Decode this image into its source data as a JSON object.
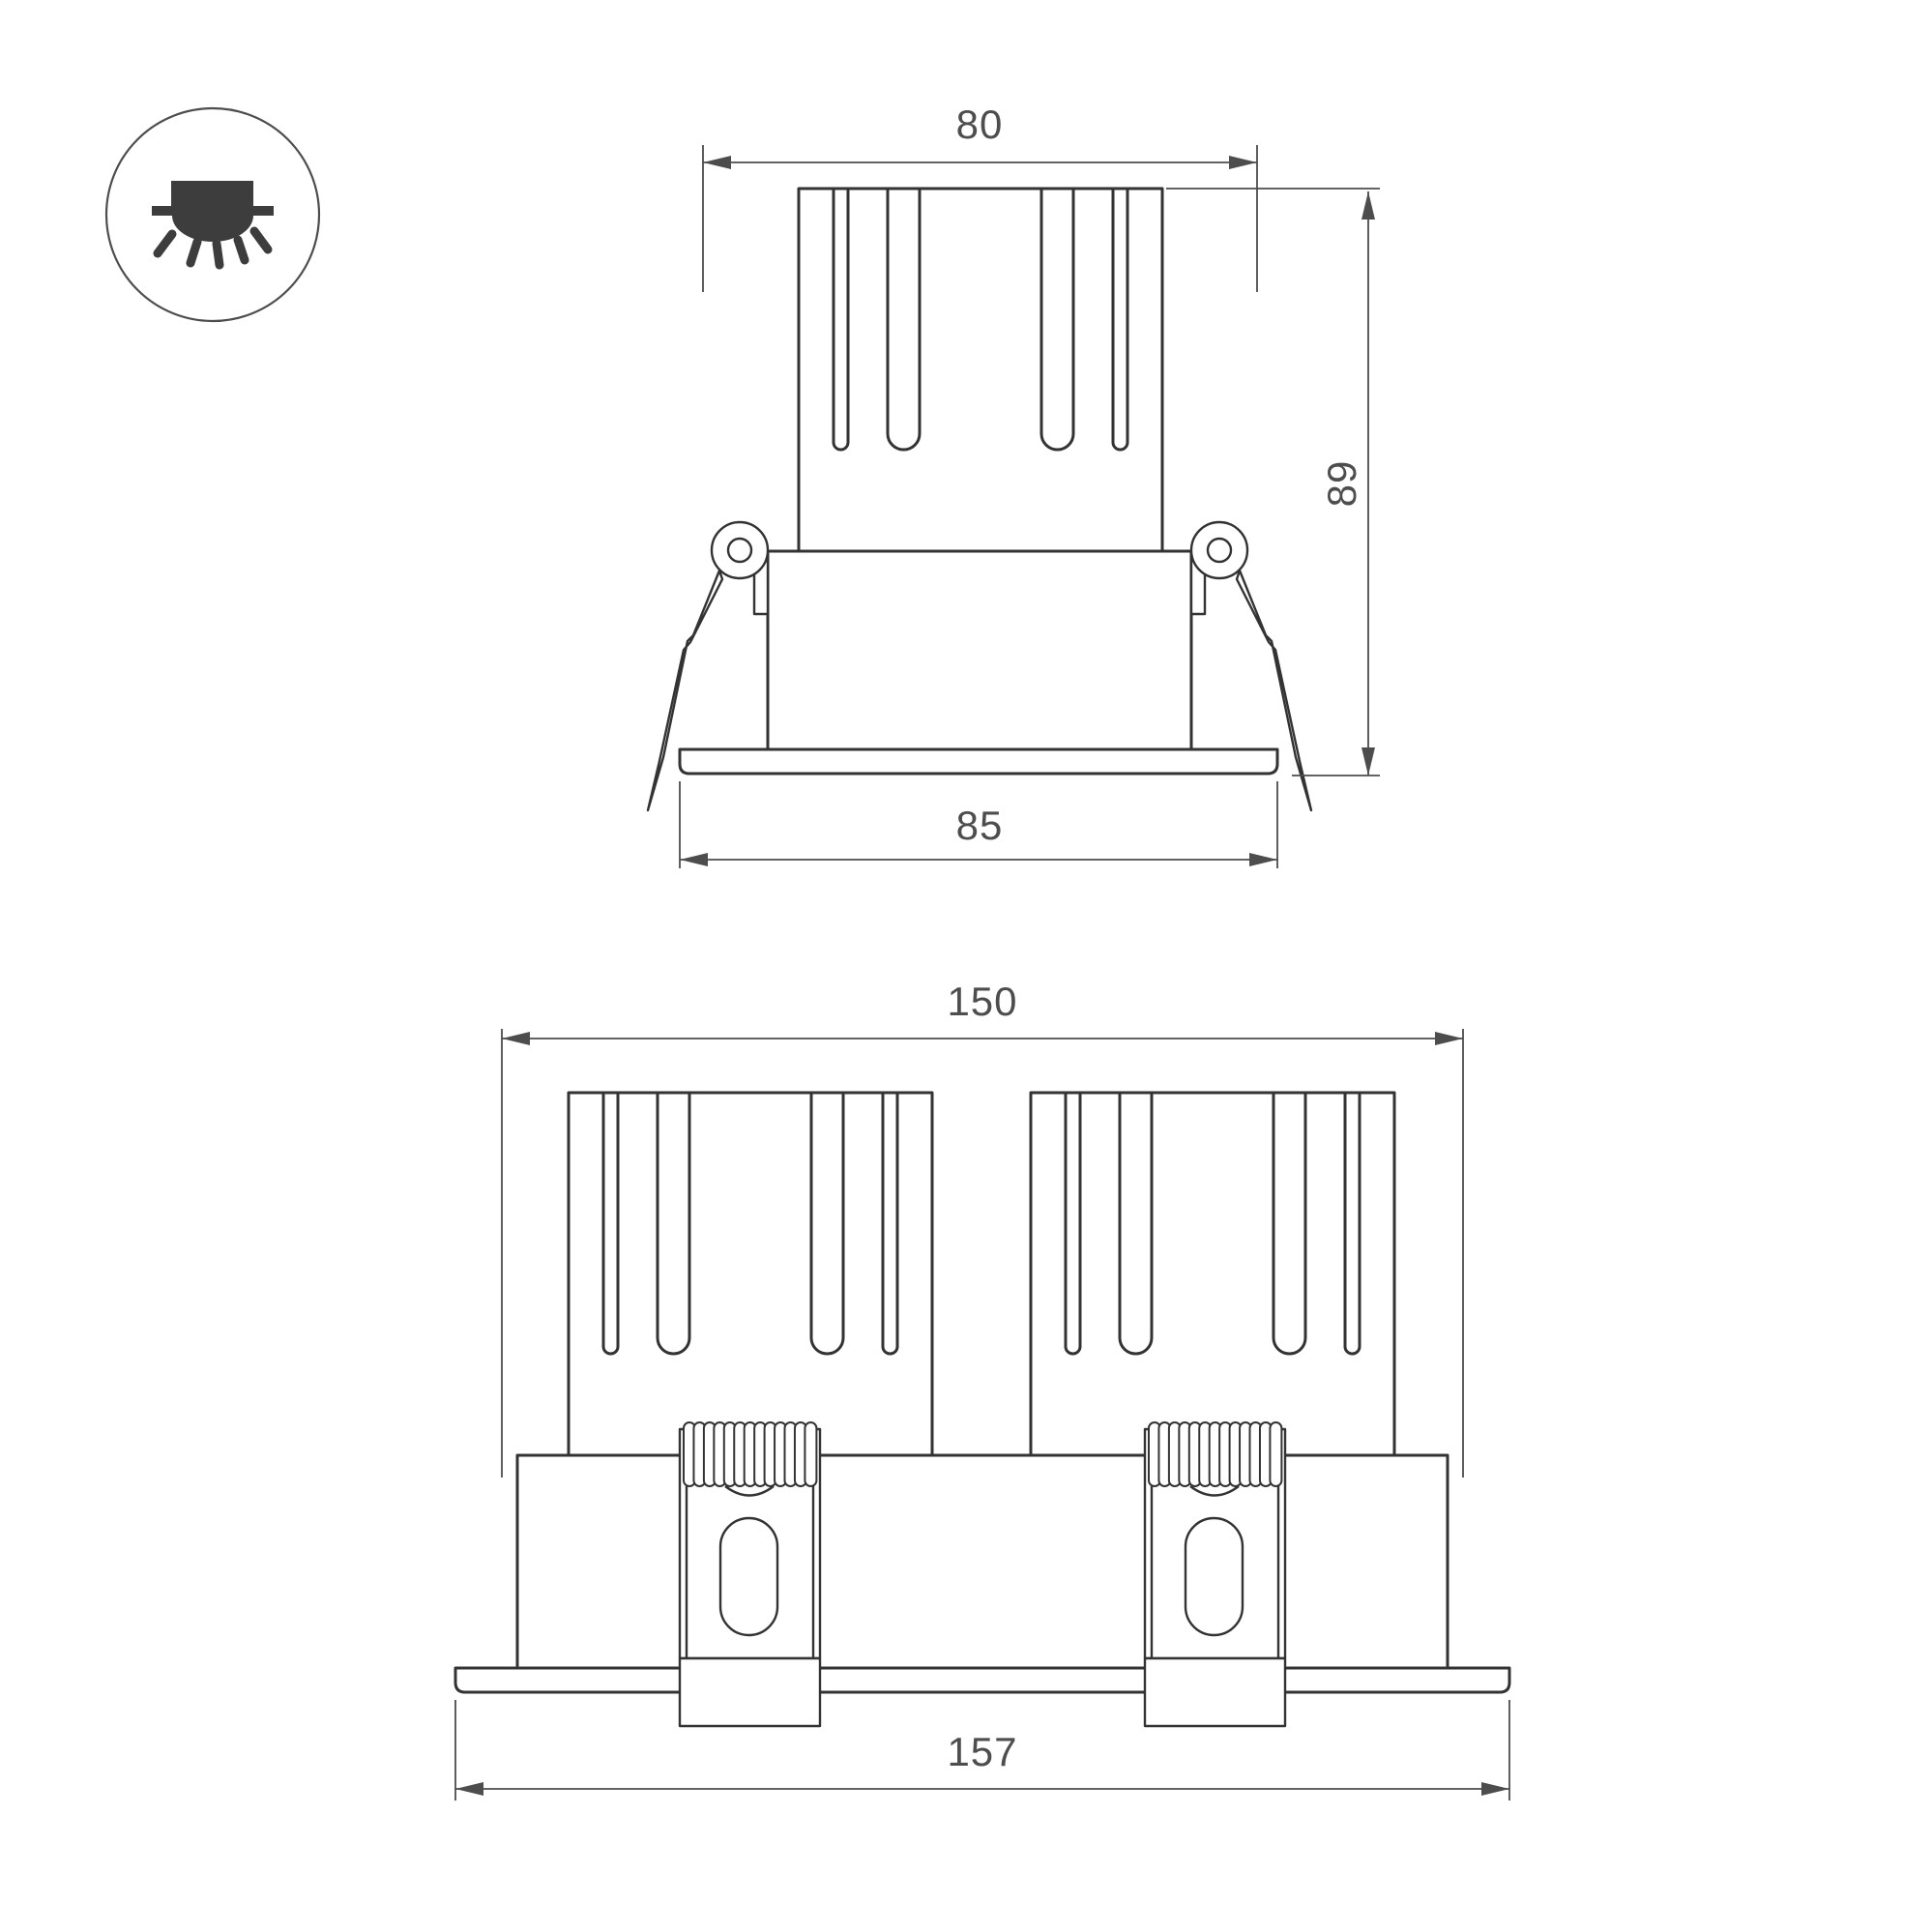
{
  "page": {
    "background": "#ffffff",
    "type": "technical dimensional drawing of recessed LED downlight"
  },
  "icon": {
    "name": "recessed-downlight-icon",
    "glyph_color": "#3d3d3d",
    "ring_color": "#4d4d4d"
  },
  "colors": {
    "object_line": "#333333",
    "dimension_line": "#4d4d4d",
    "dimension_text": "#4d4d4d"
  },
  "views": {
    "single": {
      "title": "single fixture front view",
      "dims": {
        "width_top": "80",
        "height": "89",
        "width_flange": "85"
      }
    },
    "double": {
      "title": "double fixture front view",
      "dims": {
        "width_top": "150",
        "width_flange": "157"
      }
    }
  }
}
